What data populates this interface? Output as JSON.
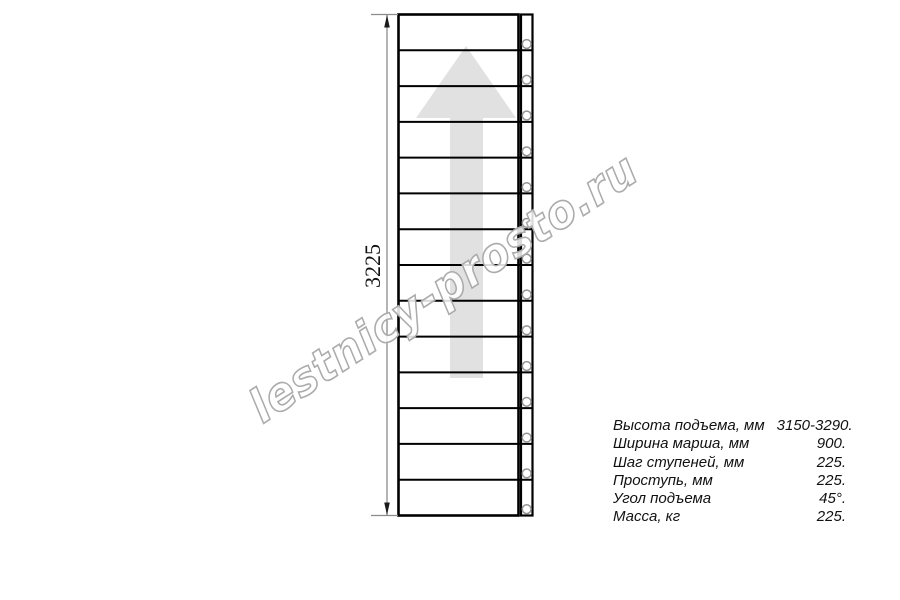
{
  "drawing": {
    "type": "staircase-plan-top-view",
    "dimension_label": "3225",
    "step_count": 14,
    "bolt_count": 14,
    "direction_arrow": "up",
    "watermark_text": "lestnicy-prosto.ru",
    "colors": {
      "outline": "#000000",
      "dimension_line": "#8c8c8c",
      "arrow_fill": "#e1e1e1",
      "bolt_stroke": "#949494",
      "watermark_stroke": "#ababab"
    }
  },
  "specs": {
    "rows": [
      {
        "label": "Высота подъема, мм",
        "value": "3150-3290."
      },
      {
        "label": "Ширина марша, мм",
        "value": "900."
      },
      {
        "label": "Шаг ступеней, мм",
        "value": "225."
      },
      {
        "label": "Проступь, мм",
        "value": "225."
      },
      {
        "label": "Угол подъема",
        "value": "45°."
      },
      {
        "label": "Масса, кг",
        "value": "225."
      }
    ]
  }
}
